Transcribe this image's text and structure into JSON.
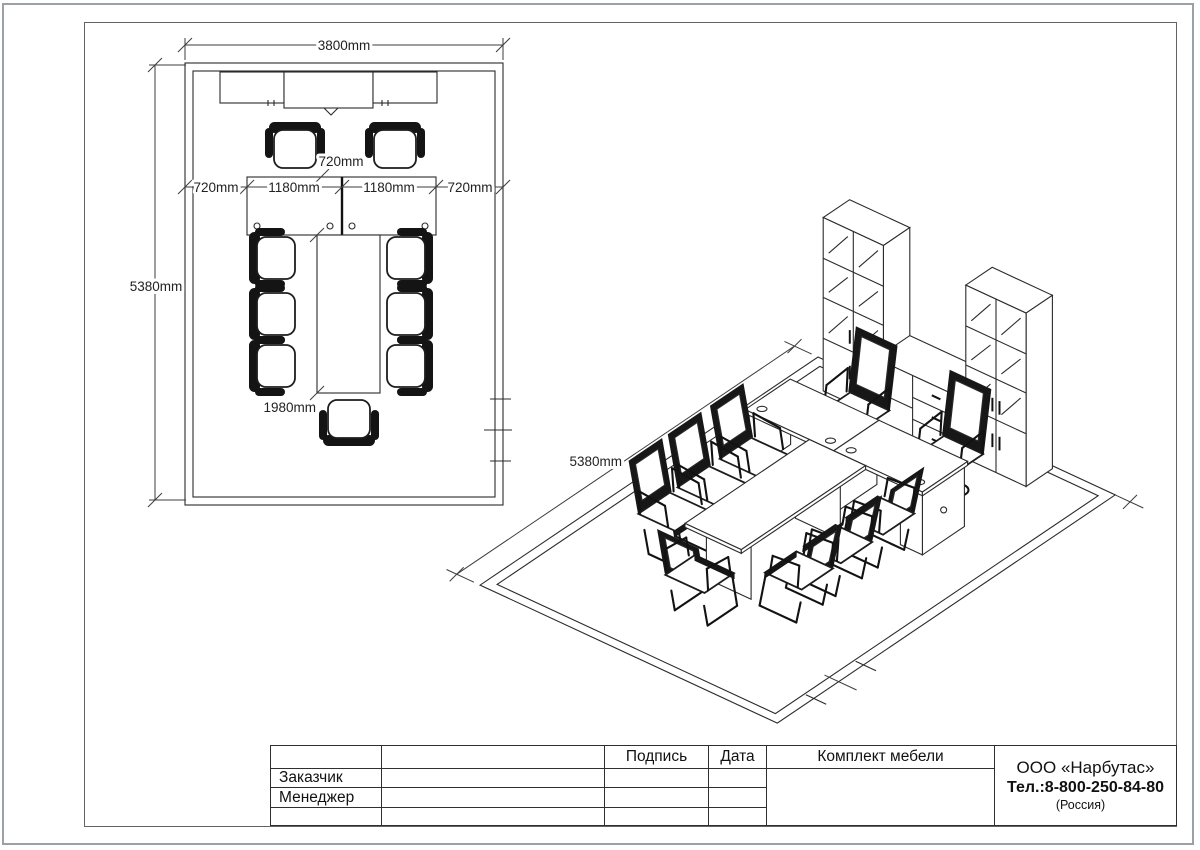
{
  "drawing": {
    "plan": {
      "dim_width": "3800mm",
      "dim_depth": "5380mm",
      "dim_wall_left": "720mm",
      "dim_desk_left": "1180mm",
      "dim_desk_right": "1180mm",
      "dim_wall_right": "720mm",
      "dim_table_width": "720mm",
      "dim_table_length": "1980mm"
    },
    "iso": {
      "dim_depth": "5380mm"
    }
  },
  "title_block": {
    "signature_header": "Подпись",
    "date_header": "Дата",
    "set_header": "Комплект мебели",
    "customer_label": "Заказчик",
    "manager_label": "Менеджер",
    "company_name": "ООО «Нарбутас»",
    "company_phone": "Тел.:8-800-250-84-80",
    "company_country": "(Россия)"
  },
  "colors": {
    "line": "#2b2b2b",
    "frame": "#606467",
    "page_edge": "#9ba1a4"
  }
}
